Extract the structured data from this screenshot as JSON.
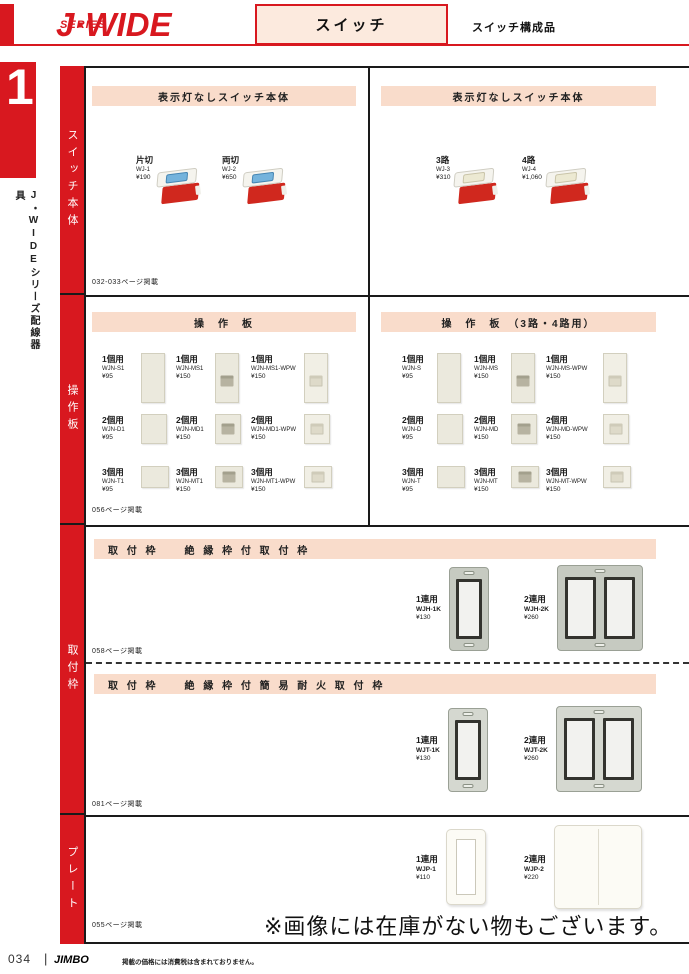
{
  "header": {
    "logo_main": "J·WIDE",
    "logo_sub": "SERIES",
    "category": "スイッチ",
    "subcategory": "スイッチ構成品"
  },
  "sidebar": {
    "chapter": "1",
    "series": "J・WIDEシリーズ配線器具",
    "tabs": [
      "スイッチ本体",
      "操作板",
      "取付枠",
      "プレート"
    ]
  },
  "s1": {
    "left": {
      "title": "表示灯なしスイッチ本体",
      "note": "032-033ページ掲載",
      "items": [
        {
          "name": "片切",
          "code": "WJ-1",
          "price": "¥190"
        },
        {
          "name": "両切",
          "code": "WJ-2",
          "price": "¥650"
        }
      ]
    },
    "right": {
      "title": "表示灯なしスイッチ本体",
      "items": [
        {
          "name": "3路",
          "code": "WJ-3",
          "price": "¥310"
        },
        {
          "name": "4路",
          "code": "WJ-4",
          "price": "¥1,060"
        }
      ]
    }
  },
  "s2": {
    "left": {
      "title": "操　作　板",
      "note": "056ページ掲載",
      "rows": [
        [
          {
            "name": "1個用",
            "code": "WJN-S1",
            "price": "¥95"
          },
          {
            "name": "1個用",
            "code": "WJN-MS1",
            "price": "¥150"
          },
          {
            "name": "1個用",
            "code": "WJN-MS1-WPW",
            "price": "¥150"
          }
        ],
        [
          {
            "name": "2個用",
            "code": "WJN-D1",
            "price": "¥95"
          },
          {
            "name": "2個用",
            "code": "WJN-MD1",
            "price": "¥150"
          },
          {
            "name": "2個用",
            "code": "WJN-MD1-WPW",
            "price": "¥150"
          }
        ],
        [
          {
            "name": "3個用",
            "code": "WJN-T1",
            "price": "¥95"
          },
          {
            "name": "3個用",
            "code": "WJN-MT1",
            "price": "¥150"
          },
          {
            "name": "3個用",
            "code": "WJN-MT1-WPW",
            "price": "¥150"
          }
        ]
      ]
    },
    "right": {
      "title": "操　作　板　（3路・4路用）",
      "rows": [
        [
          {
            "name": "1個用",
            "code": "WJN-S",
            "price": "¥95"
          },
          {
            "name": "1個用",
            "code": "WJN-MS",
            "price": "¥150"
          },
          {
            "name": "1個用",
            "code": "WJN-MS-WPW",
            "price": "¥150"
          }
        ],
        [
          {
            "name": "2個用",
            "code": "WJN-D",
            "price": "¥95"
          },
          {
            "name": "2個用",
            "code": "WJN-MD",
            "price": "¥150"
          },
          {
            "name": "2個用",
            "code": "WJN-MD-WPW",
            "price": "¥150"
          }
        ],
        [
          {
            "name": "3個用",
            "code": "WJN-T",
            "price": "¥95"
          },
          {
            "name": "3個用",
            "code": "WJN-MT",
            "price": "¥150"
          },
          {
            "name": "3個用",
            "code": "WJN-MT-WPW",
            "price": "¥150"
          }
        ]
      ]
    }
  },
  "s3": {
    "a": {
      "title": "取 付 枠　　絶 縁 枠 付 取 付 枠",
      "note": "058ページ掲載",
      "items": [
        {
          "name": "1連用",
          "code": "WJH-1K",
          "price": "¥130"
        },
        {
          "name": "2連用",
          "code": "WJH-2K",
          "price": "¥260"
        }
      ]
    },
    "b": {
      "title": "取 付 枠　　絶 縁 枠 付 簡 易 耐 火 取 付 枠",
      "note": "081ページ掲載",
      "items": [
        {
          "name": "1連用",
          "code": "WJT-1K",
          "price": "¥130"
        },
        {
          "name": "2連用",
          "code": "WJT-2K",
          "price": "¥260"
        }
      ]
    }
  },
  "s4": {
    "note": "055ページ掲載",
    "notice": "※画像には在庫がない物もございます。",
    "items": [
      {
        "name": "1連用",
        "code": "WJP-1",
        "price": "¥110"
      },
      {
        "name": "2連用",
        "code": "WJP-2",
        "price": "¥220"
      }
    ]
  },
  "footer": {
    "page": "034",
    "separator": "|",
    "brand": "JIMBO",
    "tax_note": "掲載の価格には消費税は含まれておりません。"
  },
  "colors": {
    "brand_red": "#d8181f",
    "banner_pink": "#f9dccb",
    "line_black": "#1a1a1a",
    "plate_beige": "#ebe9dd",
    "rocker_blue": "#74b3dc"
  }
}
